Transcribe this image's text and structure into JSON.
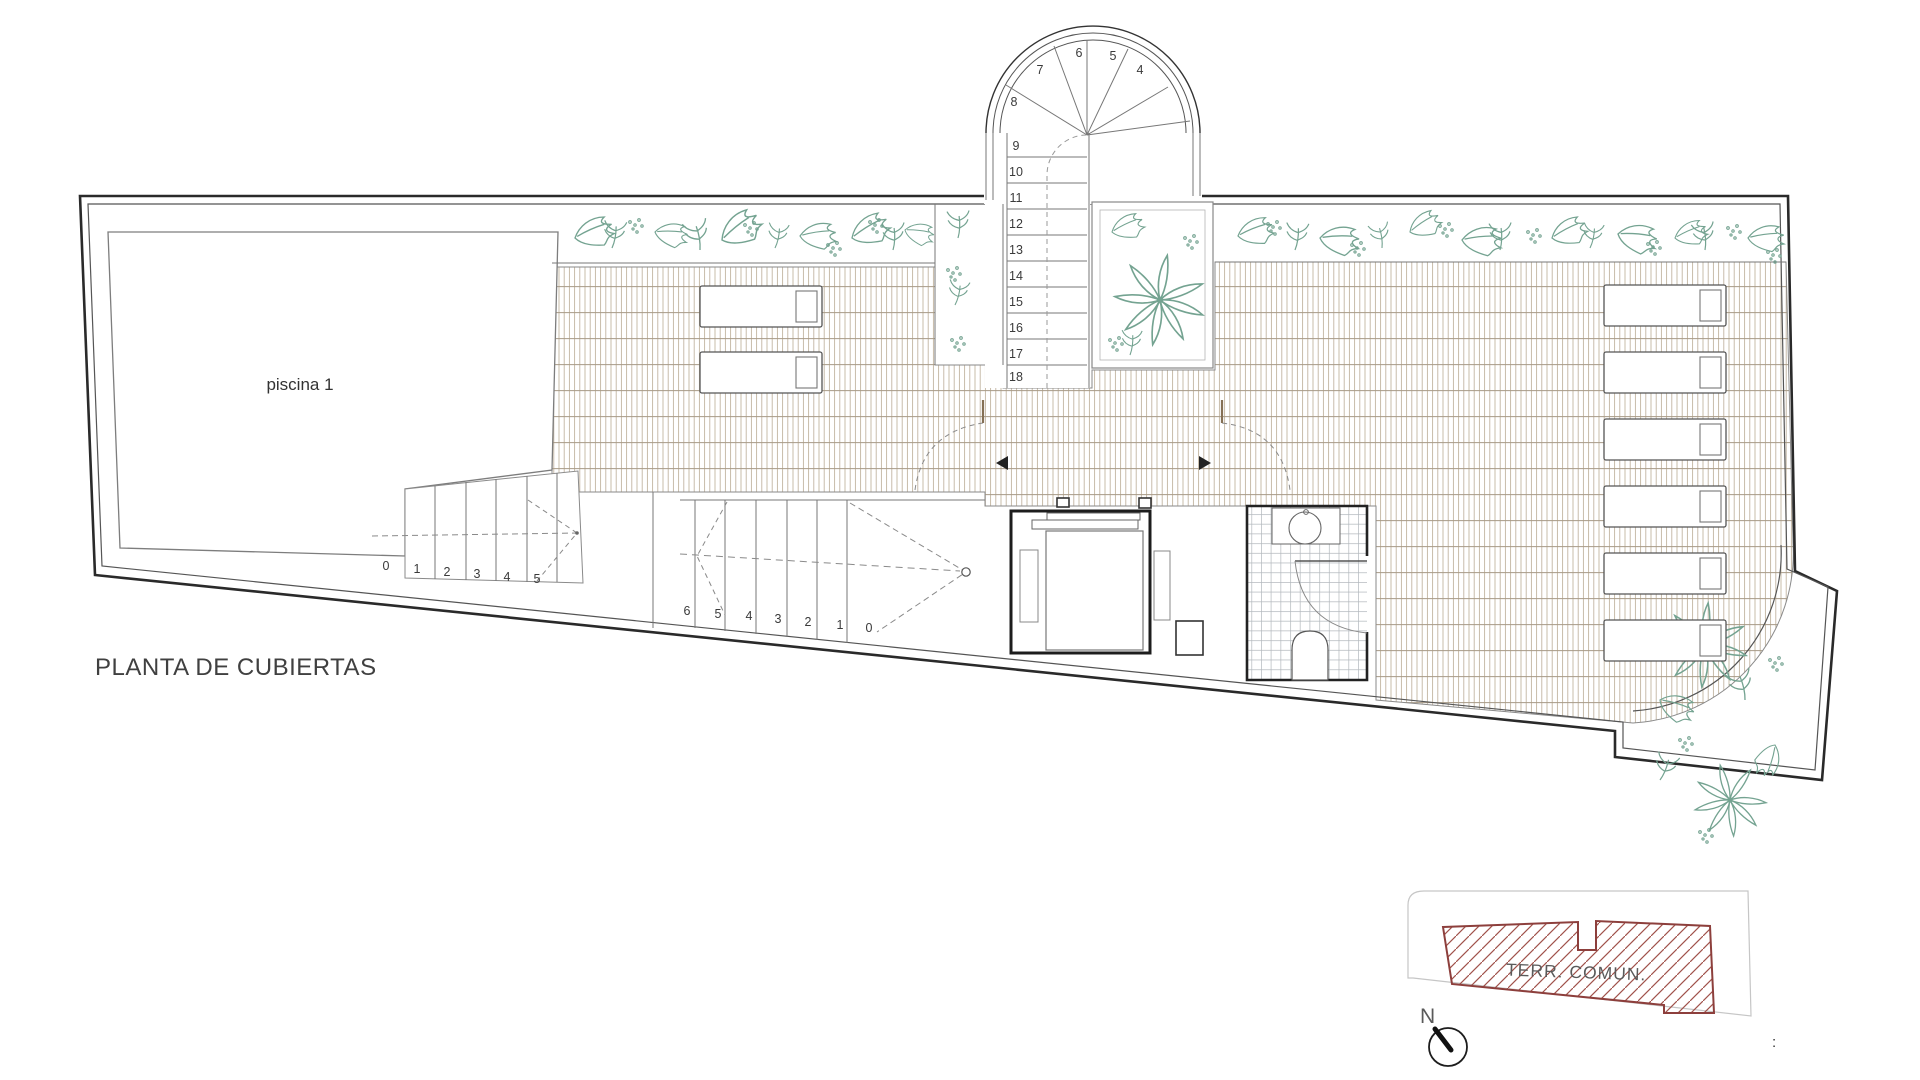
{
  "title": "PLANTA DE CUBIERTAS",
  "pool": {
    "label": "piscina 1"
  },
  "keyplan": {
    "label": "TERR. COMUN.",
    "north_label": "N",
    "stray_mark": ":",
    "hatch_color": "#a0524b",
    "outline_color": "#8d3f3c"
  },
  "stairs": {
    "tower_numbers": [
      "4",
      "5",
      "6",
      "7",
      "8",
      "9",
      "10",
      "11",
      "12",
      "13",
      "14",
      "15",
      "16",
      "17",
      "18"
    ],
    "pool_stair_numbers": [
      "0",
      "1",
      "2",
      "3",
      "4",
      "5"
    ],
    "main_stair_numbers": [
      "6",
      "5",
      "4",
      "3",
      "2",
      "1",
      "0"
    ]
  },
  "colors": {
    "roof_tile_line": "#c2b5a1",
    "roof_band_line": "#a79a86",
    "vegetation": "#74a391",
    "outline": "#2a2a2a"
  }
}
